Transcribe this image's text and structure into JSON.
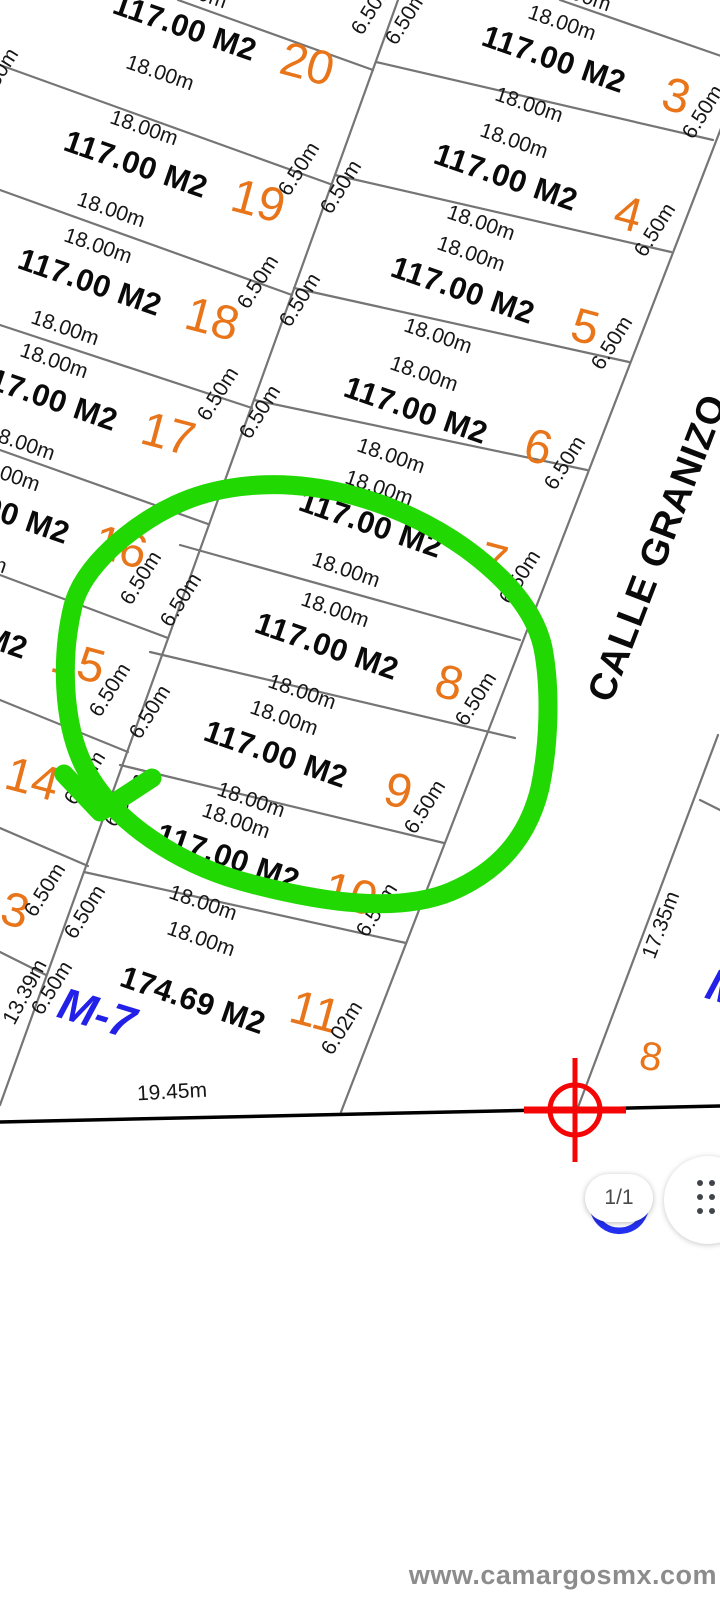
{
  "viewer": {
    "page_indicator": "1/1",
    "grid_button_icon": "apps-grid-icon"
  },
  "map": {
    "watermark": "www.camargosmx.com",
    "street_name": "CALLE GRANIZO",
    "block_label": "M-7",
    "defaults": {
      "area": "117.00 M2",
      "edge": "18.00m",
      "side": "6.50m"
    },
    "colors": {
      "lot_number_orange": "#E8751A",
      "green_annotation": "#22D803",
      "crosshair_red": "#F40606",
      "block_label_blue": "#2320E8",
      "parcel_line_gray": "#757575"
    },
    "lots": [
      {
        "no": "20",
        "col": "left",
        "xy": [
          307,
          65
        ]
      },
      {
        "no": "19",
        "col": "left",
        "xy": [
          258,
          202
        ]
      },
      {
        "no": "18",
        "col": "left",
        "xy": [
          212,
          320
        ]
      },
      {
        "no": "17",
        "col": "left",
        "xy": [
          168,
          435
        ]
      },
      {
        "no": "16",
        "col": "left",
        "xy": [
          120,
          548
        ]
      },
      {
        "no": "15",
        "col": "left",
        "xy": [
          78,
          663
        ]
      },
      {
        "no": "14",
        "col": "left",
        "xy": [
          32,
          780
        ]
      },
      {
        "no": "13",
        "col": "left",
        "xy": [
          2,
          908
        ]
      },
      {
        "no": "3",
        "col": "right",
        "xy": [
          676,
          97
        ]
      },
      {
        "no": "4",
        "col": "right",
        "xy": [
          628,
          215
        ]
      },
      {
        "no": "5",
        "col": "right",
        "xy": [
          585,
          328
        ]
      },
      {
        "no": "6",
        "col": "right",
        "xy": [
          538,
          448
        ]
      },
      {
        "no": "7",
        "col": "right",
        "xy": [
          493,
          562
        ]
      },
      {
        "no": "8",
        "col": "right",
        "xy": [
          449,
          684
        ]
      },
      {
        "no": "9",
        "col": "right",
        "xy": [
          398,
          792
        ]
      },
      {
        "no": "10",
        "col": "right",
        "xy": [
          350,
          895
        ]
      },
      {
        "no": "11",
        "col": "right",
        "xy": [
          315,
          1013
        ],
        "area": "174.69 M2",
        "area_xy": [
          193,
          1000
        ],
        "side": "6.02m",
        "bot": false
      }
    ],
    "side_pairs": [
      [
        372,
        8
      ],
      [
        406,
        18
      ],
      [
        299,
        169
      ],
      [
        341,
        187
      ],
      [
        258,
        282
      ],
      [
        300,
        300
      ],
      [
        218,
        394
      ],
      [
        260,
        412
      ],
      [
        141,
        578
      ],
      [
        181,
        600
      ],
      [
        110,
        690
      ],
      [
        150,
        712
      ],
      [
        85,
        778
      ],
      [
        125,
        800
      ],
      [
        45,
        890
      ],
      [
        85,
        912
      ],
      [
        52,
        988
      ]
    ],
    "annotations": [
      {
        "n": "street-name",
        "t": "CALLE GRANIZO",
        "x": 658,
        "y": 548,
        "r": -69,
        "c": "street"
      },
      {
        "n": "block-label-m7",
        "t": "M-7",
        "x": 97,
        "y": 1013,
        "r": 17,
        "c": "blk"
      },
      {
        "n": "adjacent-block-label-partial",
        "t": "M",
        "x": 726,
        "y": 988,
        "r": 17,
        "c": "blk"
      },
      {
        "n": "adjacent-lot-number-8",
        "t": "8",
        "x": 651,
        "y": 1057,
        "r": 10,
        "c": "num",
        "s": 40
      },
      {
        "n": "dim-17-35m",
        "t": "17.35m",
        "x": 661,
        "y": 925,
        "r": -69,
        "c": "dim"
      },
      {
        "n": "dim-19-45m",
        "t": "19.45m",
        "x": 172,
        "y": 1092,
        "r": -3,
        "c": "dim"
      },
      {
        "n": "dim-13-39m",
        "t": "13.39m",
        "x": 25,
        "y": 992,
        "r": -62,
        "c": "dim"
      },
      {
        "n": "edge-partial-top-right",
        "t": "18.00m",
        "x": 577,
        "y": -6,
        "r": 19,
        "c": "dim"
      },
      {
        "n": "side-partial-top-left",
        "t": "6.50m",
        "x": -14,
        "y": 10,
        "r": -58,
        "c": "dim"
      },
      {
        "n": "side-partial-left-lot20",
        "t": "6.50m",
        "x": -2,
        "y": 75,
        "r": -58,
        "c": "dim"
      }
    ]
  }
}
